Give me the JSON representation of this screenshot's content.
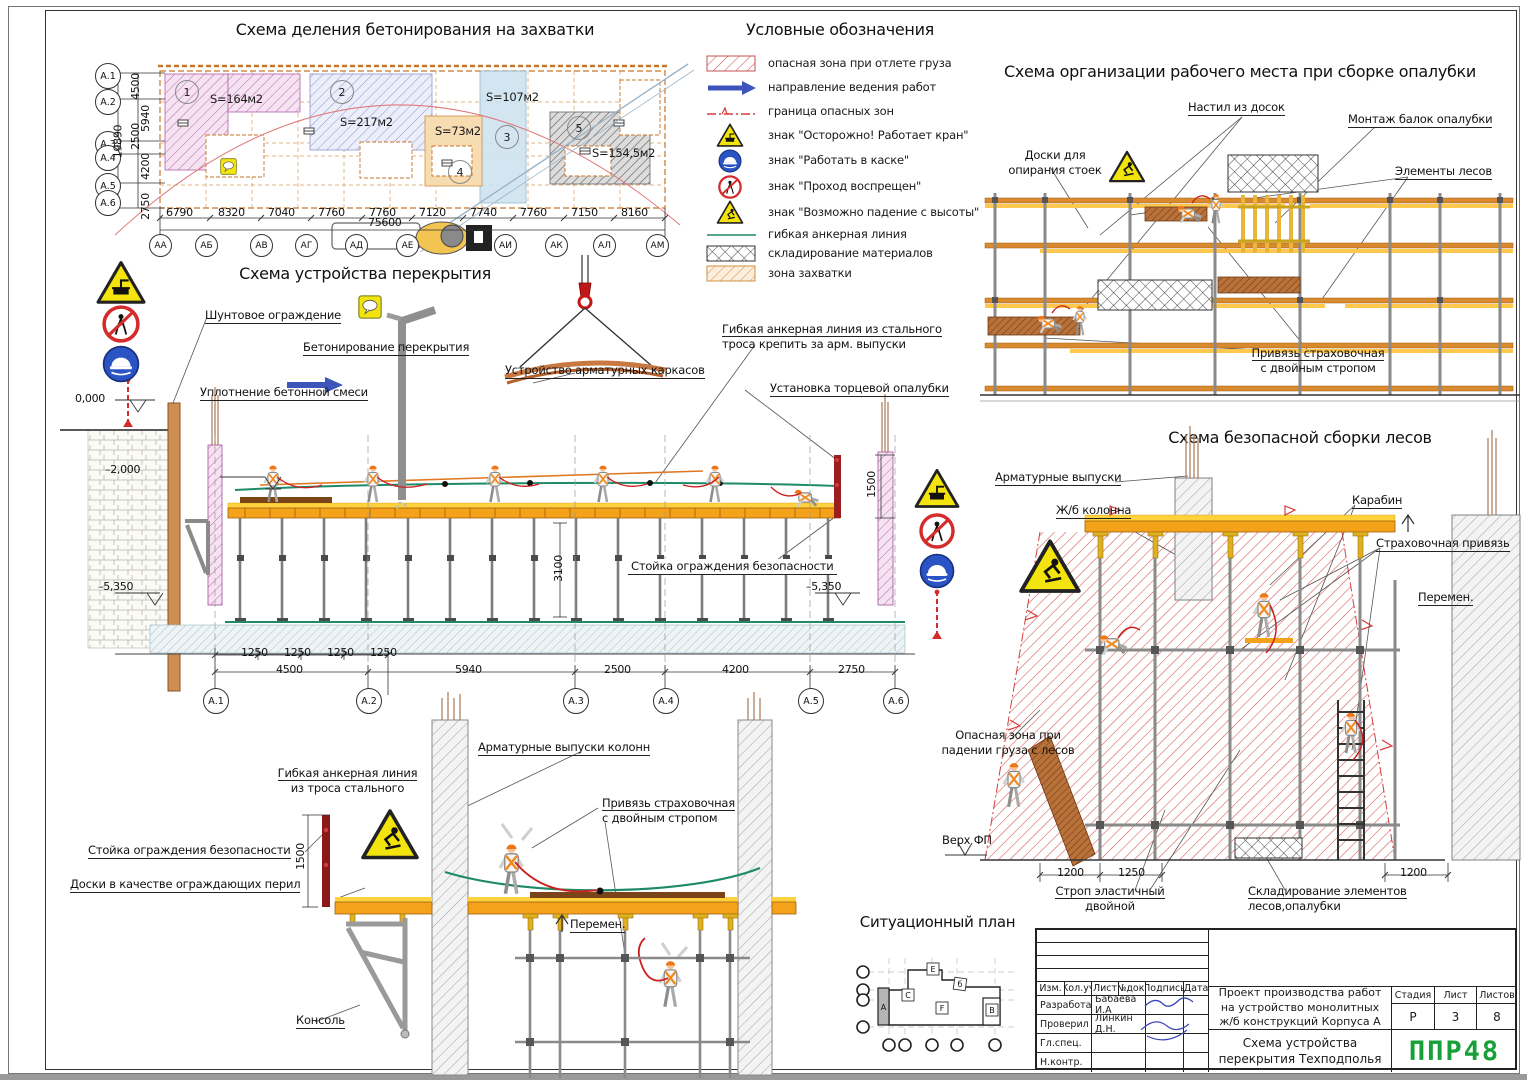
{
  "capture_plan": {
    "title": "Схема деления бетонирования на захватки",
    "zones": [
      {
        "num": "1",
        "area": "S=164м2"
      },
      {
        "num": "2",
        "area": "S=217м2"
      },
      {
        "num": "3",
        "area": "S=107м2"
      },
      {
        "num": "4",
        "area": "S=73м2"
      },
      {
        "num": "5",
        "area": "S=154,5м2"
      }
    ],
    "axes_left": [
      "А.1",
      "А.2",
      "А.3",
      "А.4",
      "А.5",
      "А.6"
    ],
    "dims_left": [
      "4500",
      "5940",
      "2500",
      "4200",
      "2750"
    ],
    "total_left": "19890",
    "axes_bottom": [
      "АА",
      "АБ",
      "АВ",
      "АГ",
      "АД",
      "АЕ",
      "АИ",
      "АК",
      "АЛ",
      "АМ"
    ],
    "dims_bottom": [
      "6790",
      "8320",
      "7040",
      "7760",
      "7760",
      "7120",
      "7740",
      "7760",
      "7150",
      "8160"
    ],
    "total_bottom": "75600"
  },
  "legend": {
    "title": "Условные обозначения",
    "items": [
      "опасная зона при отлете груза",
      "направление ведения работ",
      "граница опасных зон",
      "знак \"Осторожно! Работает кран\"",
      "знак \"Работать в каске\"",
      "знак \"Проход воспрещен\"",
      "знак \"Возможно падение с высоты\"",
      "гибкая анкерная линия",
      "складирование материалов",
      "зона захватки"
    ]
  },
  "formwork_scheme": {
    "title": "Схема организации рабочего места при сборке опалубки",
    "labels": {
      "decking": "Настил из досок",
      "beams": "Монтаж балок опалубки",
      "boards": [
        "Доски для",
        "опирания стоек"
      ],
      "elements": "Элементы лесов",
      "harness": [
        "Привязь страховочная",
        "с двойным стропом"
      ]
    }
  },
  "slab_scheme": {
    "title": "Схема устройства перекрытия",
    "labels": {
      "sheet_pile": "Шунтовое ограждение",
      "concreting": "Бетонирование перекрытия",
      "compaction": "Уплотнение бетонной смеси",
      "rebar_cages": "Устройство арматурных каркасов",
      "anchor_line": [
        "Гибкая анкерная линия из стального",
        "троса крепить за арм. выпуски"
      ],
      "end_formwork": "Установка торцевой опалубки",
      "guard_post": "Стойка ограждения безопасности"
    },
    "elevations": {
      "zero": "0,000",
      "minus2": "–2,000",
      "minus5_left": "–5,350",
      "minus5_right": "–5,350"
    },
    "dim_height": "3100",
    "dim_guard": "1500",
    "dims_small": [
      "1250",
      "1250",
      "1250",
      "1250"
    ],
    "dims_main": [
      "4500",
      "5940",
      "2500",
      "4200",
      "2750"
    ],
    "axes": [
      "А.1",
      "А.2",
      "А.3",
      "А.4",
      "А.5",
      "А.6"
    ]
  },
  "scaffold_scheme": {
    "title": "Схема безопасной сборки лесов",
    "labels": {
      "rebar": "Арматурные выпуски",
      "column": "Ж/б колонна",
      "carabiner": "Карабин",
      "harness": "Страховочная привязь",
      "variable": "Перемен.",
      "danger": [
        "Опасная зона при",
        "падении груза с лесов"
      ],
      "top_fp": "Верх ФП",
      "sling": [
        "Строп эластичный",
        "двойной"
      ],
      "storage": [
        "Складирование элементов",
        "лесов,опалубки"
      ]
    },
    "dims": [
      "1200",
      "1250",
      "1200"
    ]
  },
  "detail_scheme": {
    "labels": {
      "anchor": [
        "Гибкая анкерная линия",
        "из троса стального"
      ],
      "rebar": "Арматурные выпуски колонн",
      "harness": [
        "Привязь страховочная",
        "с двойным стропом"
      ],
      "guard": "Стойка ограждения безопасности",
      "boards": "Доски в качестве ограждающих перил",
      "variable": "Перемен.",
      "console": "Консоль"
    },
    "dim_guard": "1500"
  },
  "situational_plan": {
    "title": "Ситуационный план",
    "blocks": [
      "А",
      "С",
      "Е",
      "б",
      "F",
      "В"
    ]
  },
  "title_block": {
    "headers": [
      "Изм.",
      "Кол.уч",
      "Лист",
      "№док.",
      "Подпись",
      "Дата"
    ],
    "rows": [
      {
        "role": "Разработал",
        "name": "Бабаева И.А"
      },
      {
        "role": "Проверил",
        "name": "Линкин Д.Н."
      },
      {
        "role": "Гл.спец.",
        "name": ""
      },
      {
        "role": "Н.контр.",
        "name": ""
      }
    ],
    "project": "Проект производства работ на устройство монолитных ж/б конструкций Корпуса А",
    "doc_title": "Схема устройства перекрытия Техподполья",
    "stage_label": "Стадия",
    "stage": "Р",
    "sheet_label": "Лист",
    "sheet": "3",
    "sheets_label": "Листов",
    "sheets": "8",
    "logo": "ППР48"
  }
}
